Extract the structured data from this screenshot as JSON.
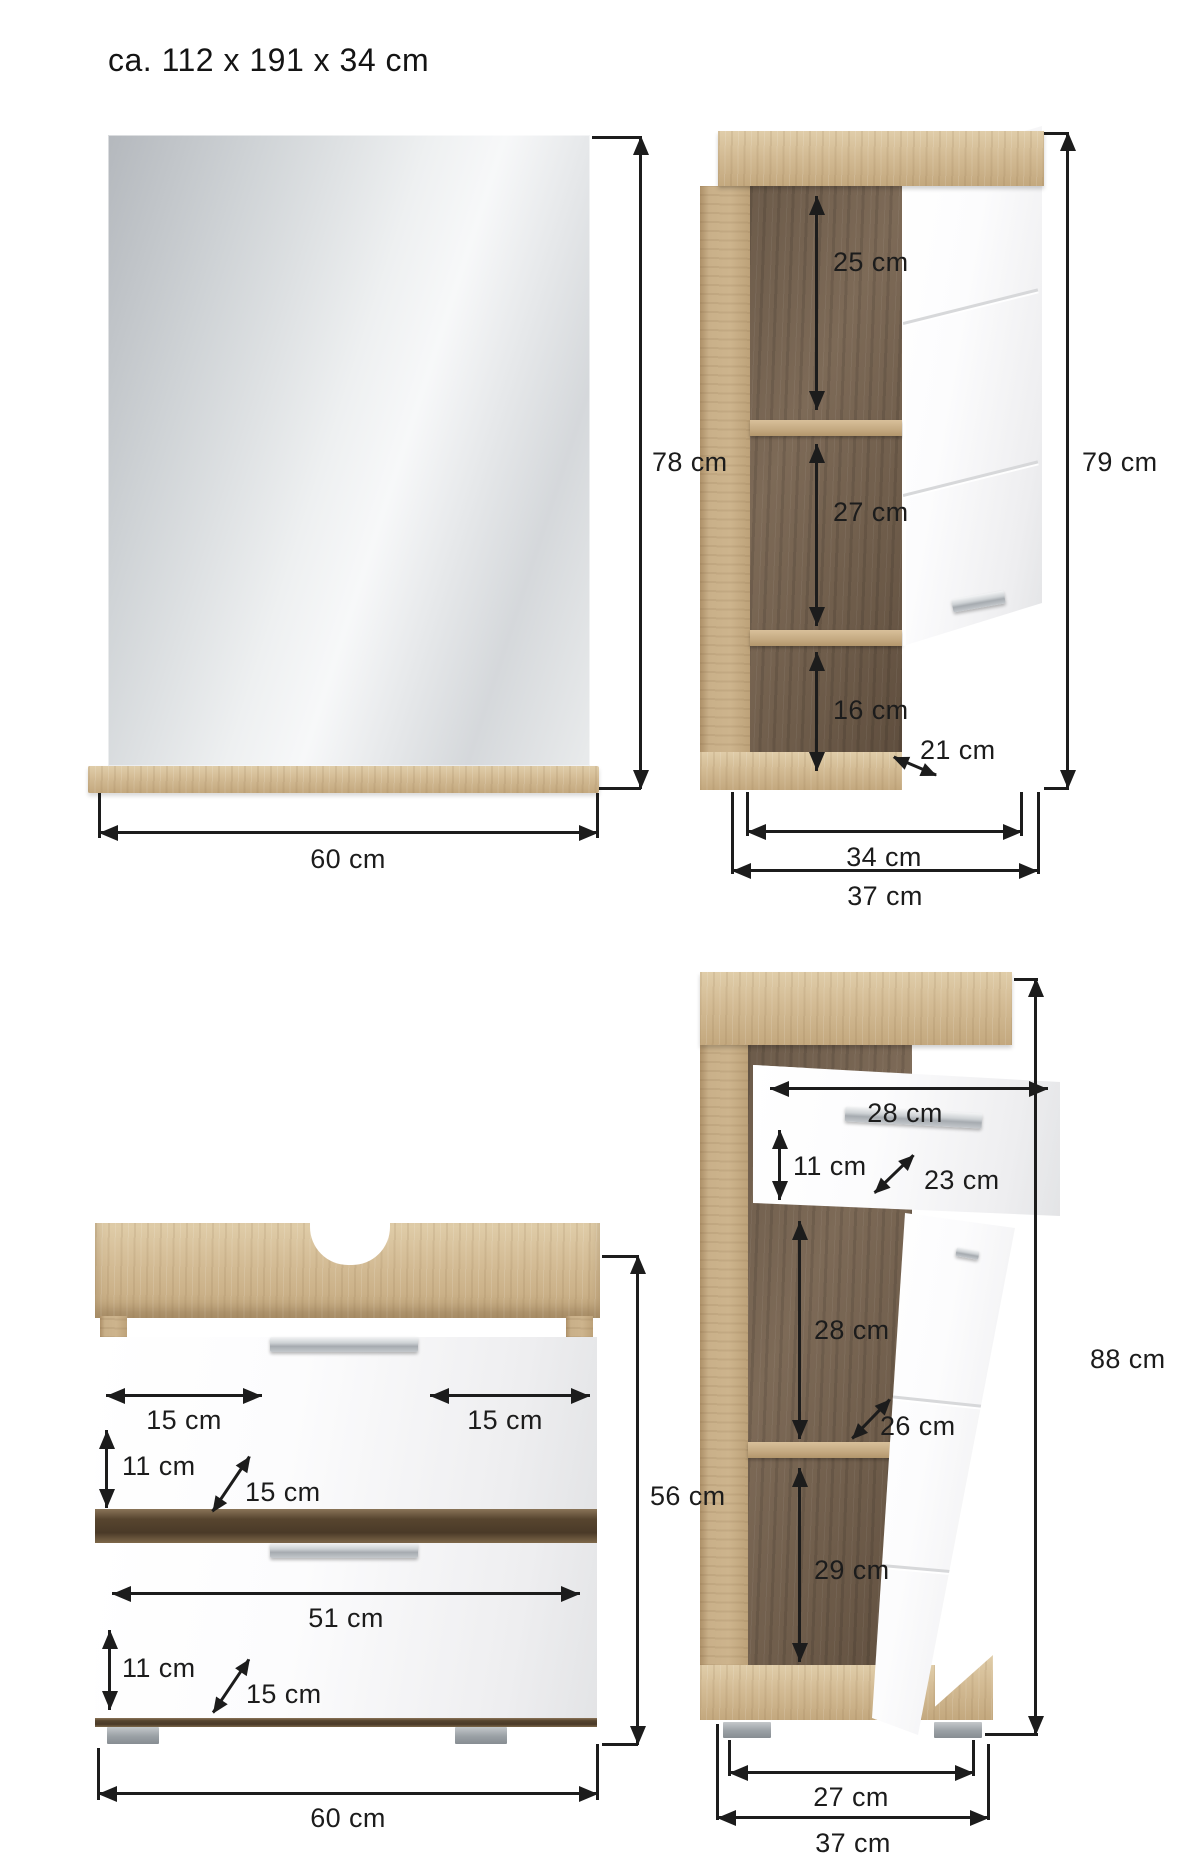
{
  "title": "ca. 112 x 191 x 34 cm",
  "colors": {
    "wood_light": "#d3bb94",
    "wood_dark": "#6f5d4b",
    "front_white": "#f5f5f6",
    "handle_silver": "#b9bdc1",
    "foot_grey": "#9aa0a5",
    "dimension_ink": "#1c1c1c"
  },
  "mirror": {
    "height": "78 cm",
    "width": "60 cm"
  },
  "wall_cabinet": {
    "height": "79 cm",
    "inner_width": "34 cm",
    "outer_width": "37 cm",
    "top_compartment": "25 cm",
    "middle_compartment": "27 cm",
    "bottom_compartment": "16 cm",
    "depth": "21 cm"
  },
  "basin_cabinet": {
    "height": "56 cm",
    "width": "60 cm",
    "drawer_top": {
      "left_gap": "15 cm",
      "right_gap": "15 cm",
      "front_height": "11 cm",
      "depth": "15 cm"
    },
    "drawer_bottom": {
      "width": "51 cm",
      "front_height": "11 cm",
      "depth": "15 cm"
    }
  },
  "tall_cabinet": {
    "height": "88 cm",
    "inner_width": "27 cm",
    "outer_width": "37 cm",
    "drawer": {
      "width": "28 cm",
      "front_height": "11 cm",
      "depth": "23 cm"
    },
    "upper_compartment": "28 cm",
    "shelf_depth": "26 cm",
    "lower_compartment": "29 cm"
  }
}
